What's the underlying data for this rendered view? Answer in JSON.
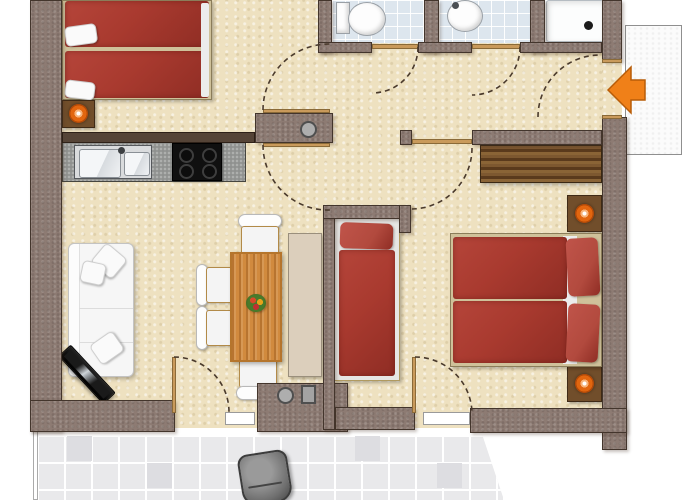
{
  "image": {
    "kind": "apartment floor plan, top-down 2D architectural rendering",
    "width_px": 700,
    "height_px": 500,
    "visible_text": "none"
  },
  "colors": {
    "wall": "#8d7b73",
    "wall_outline": "#43352c",
    "floor": "#eee1c0",
    "bath_tile": "#dde6ee",
    "terrace_tile": "#e9e9eb",
    "grout": "#ffffff",
    "bed_red": "#a93a2f",
    "bed_red_dark": "#8f2d24",
    "pillow_red": "#b24a3e",
    "bed_frame": "#cfc19a",
    "wood_table": "#d18a3e",
    "wood_table_dark": "#b5752c",
    "wardrobe_wood": "#6e4a28",
    "sideboard": "#dccfbc",
    "counter": "#8f918f",
    "cooktop": "#101010",
    "steel": "#d9dbdd",
    "sofa": "#f6f6f6",
    "nightstand": "#714e2b",
    "lamp_orange": "#e2660f",
    "threshold_wood": "#c99a5b",
    "door_arc": "#4a3a2c",
    "terrace_chair": "#6f6f6f",
    "arrow_orange": "#f08018",
    "arrow_outline": "#b85c08",
    "chair_trim": "#b28a48",
    "landing": "#fbfbfb"
  },
  "rooms": [
    {
      "name": "bedroom-top-left",
      "furniture": [
        "double bed with two red duvets and white pillows",
        "nightstand with orange lamp"
      ]
    },
    {
      "name": "kitchen",
      "furniture": [
        "gray counter",
        "stainless double sink with faucet",
        "black 4-burner cooktop"
      ]
    },
    {
      "name": "living-dining-room",
      "furniture": [
        "white sofa with cushions",
        "flat tv set diagonally",
        "wooden dining table",
        "four white chairs",
        "flower centerpiece",
        "beige sideboard"
      ]
    },
    {
      "name": "sleeping-alcove",
      "furniture": [
        "single bed with red duvet and pillow"
      ]
    },
    {
      "name": "bedroom-right",
      "furniture": [
        "double bed with two red duvets and red pillows",
        "two nightstands with orange lamps",
        "wood-grain wardrobe"
      ]
    },
    {
      "name": "bathroom-wc-1",
      "furniture": [
        "toilet"
      ],
      "floor": "light blue tiles"
    },
    {
      "name": "bathroom-wc-2",
      "furniture": [
        "washbasin"
      ],
      "floor": "light blue tiles"
    },
    {
      "name": "shower-room",
      "furniture": [
        "shower tray with drain"
      ]
    },
    {
      "name": "hallway",
      "furniture": [
        "round structural column in wall pier",
        "round and square columns in south wall"
      ]
    },
    {
      "name": "balcony-terrace",
      "furniture": [
        "dark gray garden chair"
      ],
      "floor": "large light gray tiles"
    },
    {
      "name": "entrance",
      "furniture": [
        "white landing mat",
        "orange arrow pointing left at entry door"
      ]
    }
  ],
  "doors": {
    "swing_arc_style": "dashed quarter-circle arcs",
    "swing_arc_count": 8,
    "thresholds": "tan wood strips in wall openings, white strips to terrace"
  }
}
